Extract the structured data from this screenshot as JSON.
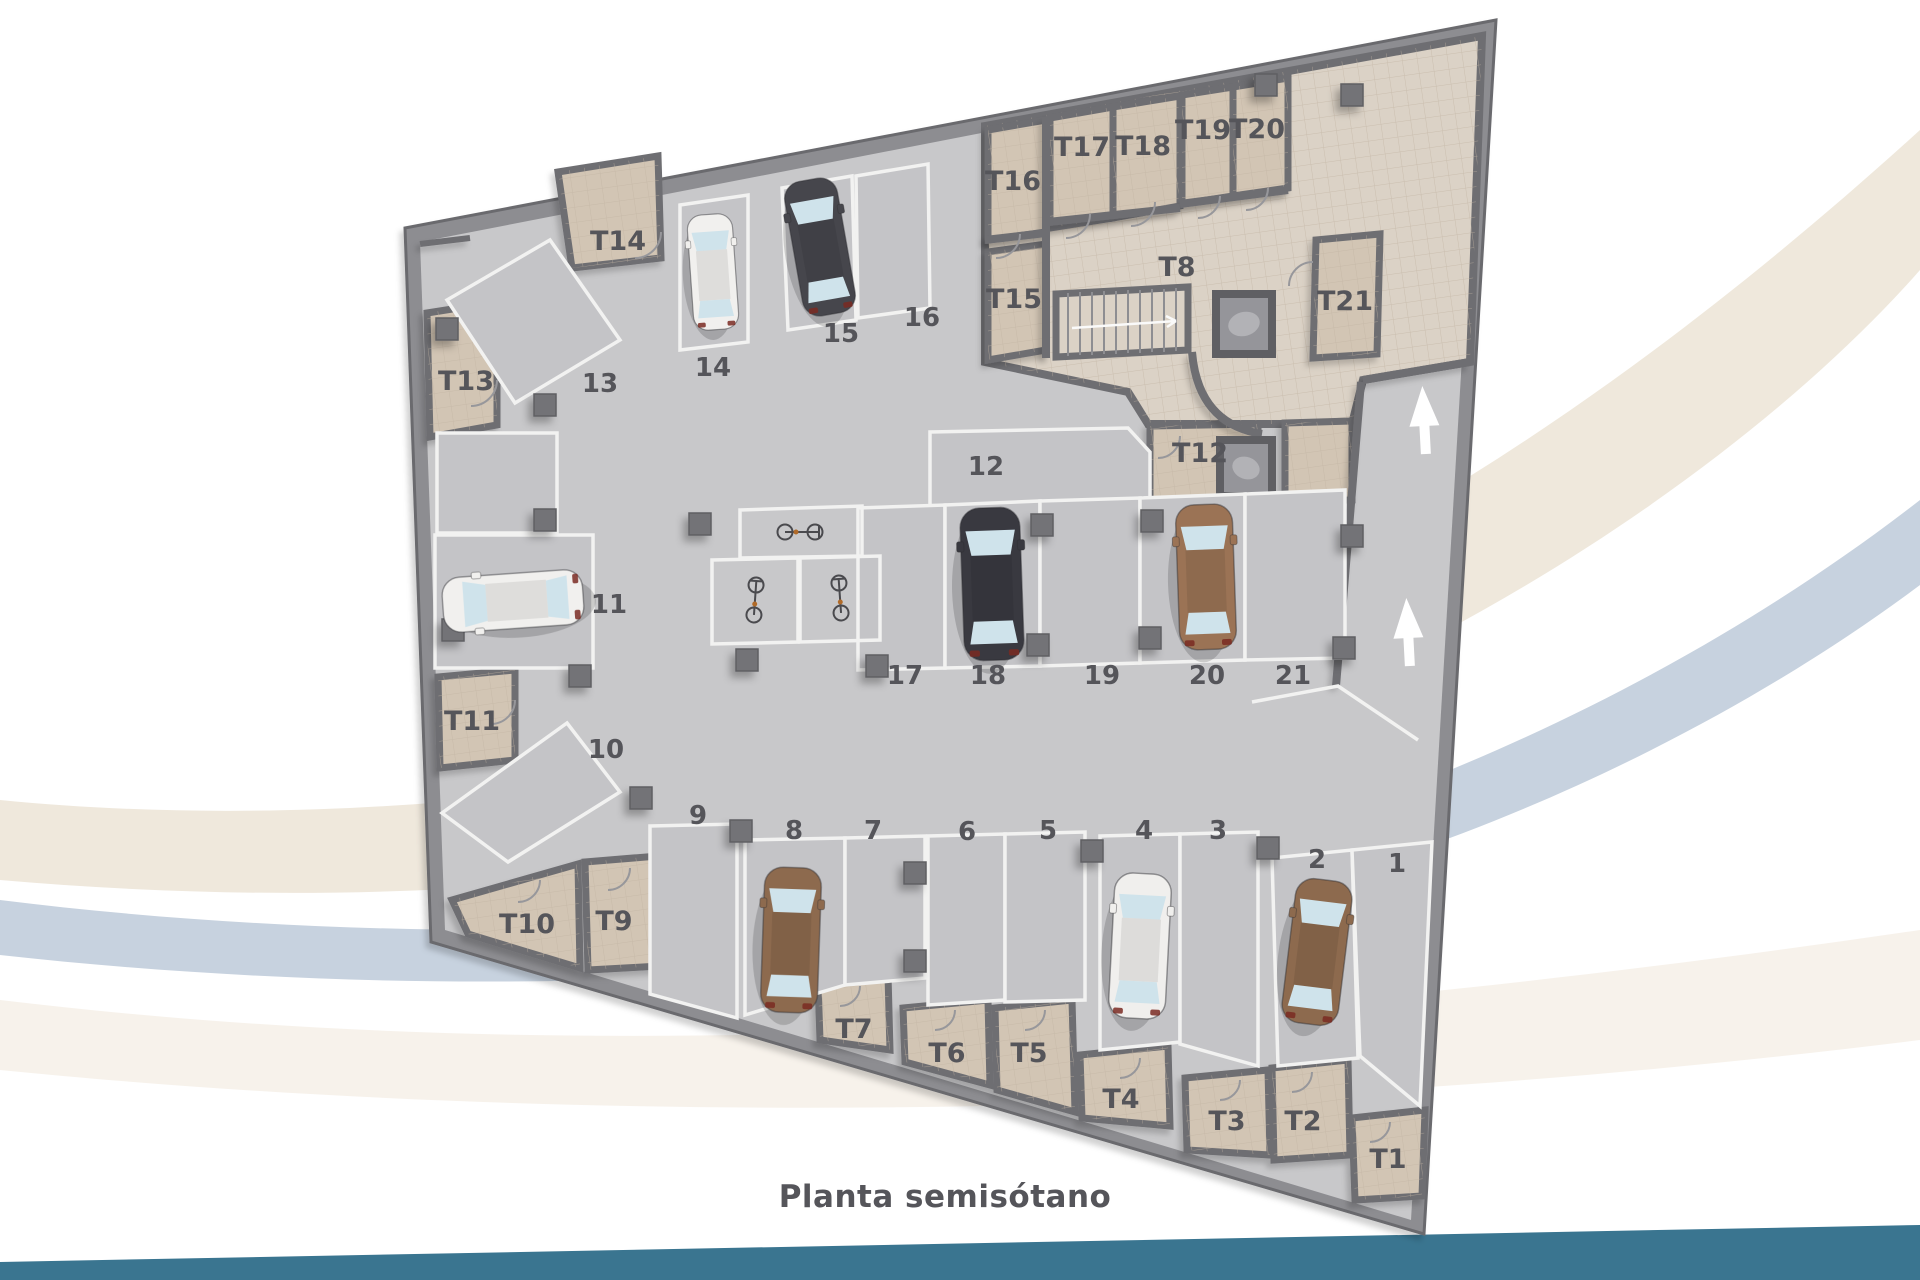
{
  "caption": {
    "text": "Planta semisótano"
  },
  "colors": {
    "background": "#ffffff",
    "floor": "#c8c8ca",
    "space_fill": "#c4c4c7",
    "wall": "#6e6e72",
    "outer_wall": "#8d8d91",
    "beige_zone": "#dbd2c6",
    "beige_room": "#d2c5b4",
    "white_line": "#f2f2f1",
    "label": "#55555a",
    "caption": "#2b6e91",
    "footer_band": "#3a7590",
    "swoosh_cream": "#efe8dc",
    "swoosh_blue": "#c7d2df",
    "arrow": "#ffffff"
  },
  "plan": {
    "storage_rooms": [
      {
        "label": "T1",
        "x": 1388,
        "y": 1168
      },
      {
        "label": "T2",
        "x": 1303,
        "y": 1130
      },
      {
        "label": "T3",
        "x": 1227,
        "y": 1130
      },
      {
        "label": "T4",
        "x": 1121,
        "y": 1108
      },
      {
        "label": "T5",
        "x": 1029,
        "y": 1062
      },
      {
        "label": "T6",
        "x": 947,
        "y": 1062
      },
      {
        "label": "T7",
        "x": 854,
        "y": 1038
      },
      {
        "label": "T8",
        "x": 1177,
        "y": 276
      },
      {
        "label": "T9",
        "x": 614,
        "y": 930
      },
      {
        "label": "T10",
        "x": 527,
        "y": 933
      },
      {
        "label": "T11",
        "x": 472,
        "y": 730
      },
      {
        "label": "T12",
        "x": 1200,
        "y": 462
      },
      {
        "label": "T13",
        "x": 466,
        "y": 390
      },
      {
        "label": "T14",
        "x": 618,
        "y": 250
      },
      {
        "label": "T15",
        "x": 1014,
        "y": 308
      },
      {
        "label": "T16",
        "x": 1013,
        "y": 190
      },
      {
        "label": "T17",
        "x": 1082,
        "y": 156
      },
      {
        "label": "T18",
        "x": 1143,
        "y": 155
      },
      {
        "label": "T19",
        "x": 1203,
        "y": 139
      },
      {
        "label": "T20",
        "x": 1257,
        "y": 138
      },
      {
        "label": "T21",
        "x": 1345,
        "y": 310
      }
    ],
    "parking_spaces": [
      {
        "label": "1",
        "x": 1397,
        "y": 872
      },
      {
        "label": "2",
        "x": 1317,
        "y": 868
      },
      {
        "label": "3",
        "x": 1218,
        "y": 839
      },
      {
        "label": "4",
        "x": 1144,
        "y": 839
      },
      {
        "label": "5",
        "x": 1048,
        "y": 839
      },
      {
        "label": "6",
        "x": 967,
        "y": 840
      },
      {
        "label": "7",
        "x": 873,
        "y": 839
      },
      {
        "label": "8",
        "x": 794,
        "y": 839
      },
      {
        "label": "9",
        "x": 698,
        "y": 824
      },
      {
        "label": "10",
        "x": 606,
        "y": 758
      },
      {
        "label": "11",
        "x": 609,
        "y": 613
      },
      {
        "label": "12",
        "x": 986,
        "y": 475
      },
      {
        "label": "13",
        "x": 600,
        "y": 392
      },
      {
        "label": "14",
        "x": 713,
        "y": 376
      },
      {
        "label": "15",
        "x": 841,
        "y": 342
      },
      {
        "label": "16",
        "x": 922,
        "y": 326
      },
      {
        "label": "17",
        "x": 905,
        "y": 684
      },
      {
        "label": "18",
        "x": 988,
        "y": 684
      },
      {
        "label": "19",
        "x": 1102,
        "y": 684
      },
      {
        "label": "20",
        "x": 1207,
        "y": 684
      },
      {
        "label": "21",
        "x": 1293,
        "y": 684
      }
    ]
  },
  "cars": {
    "space14": {
      "space": "14",
      "color": "#f1f0ee"
    },
    "space15": {
      "space": "15",
      "color": "#46464c"
    },
    "space11": {
      "space": "11",
      "color": "#f1f0ee"
    },
    "space18": {
      "space": "18",
      "color": "#393940"
    },
    "space20": {
      "space": "20",
      "color": "#9b7355"
    },
    "space8": {
      "space": "8",
      "color": "#8d6a4e"
    },
    "space4": {
      "space": "4",
      "color": "#f0efed"
    },
    "space2": {
      "space": "2",
      "color": "#8d6a4e"
    }
  },
  "icons": [
    "ramp-arrow-icon",
    "stairs-icon",
    "elevator-icon",
    "bicycle-icon",
    "pillar-icon"
  ]
}
